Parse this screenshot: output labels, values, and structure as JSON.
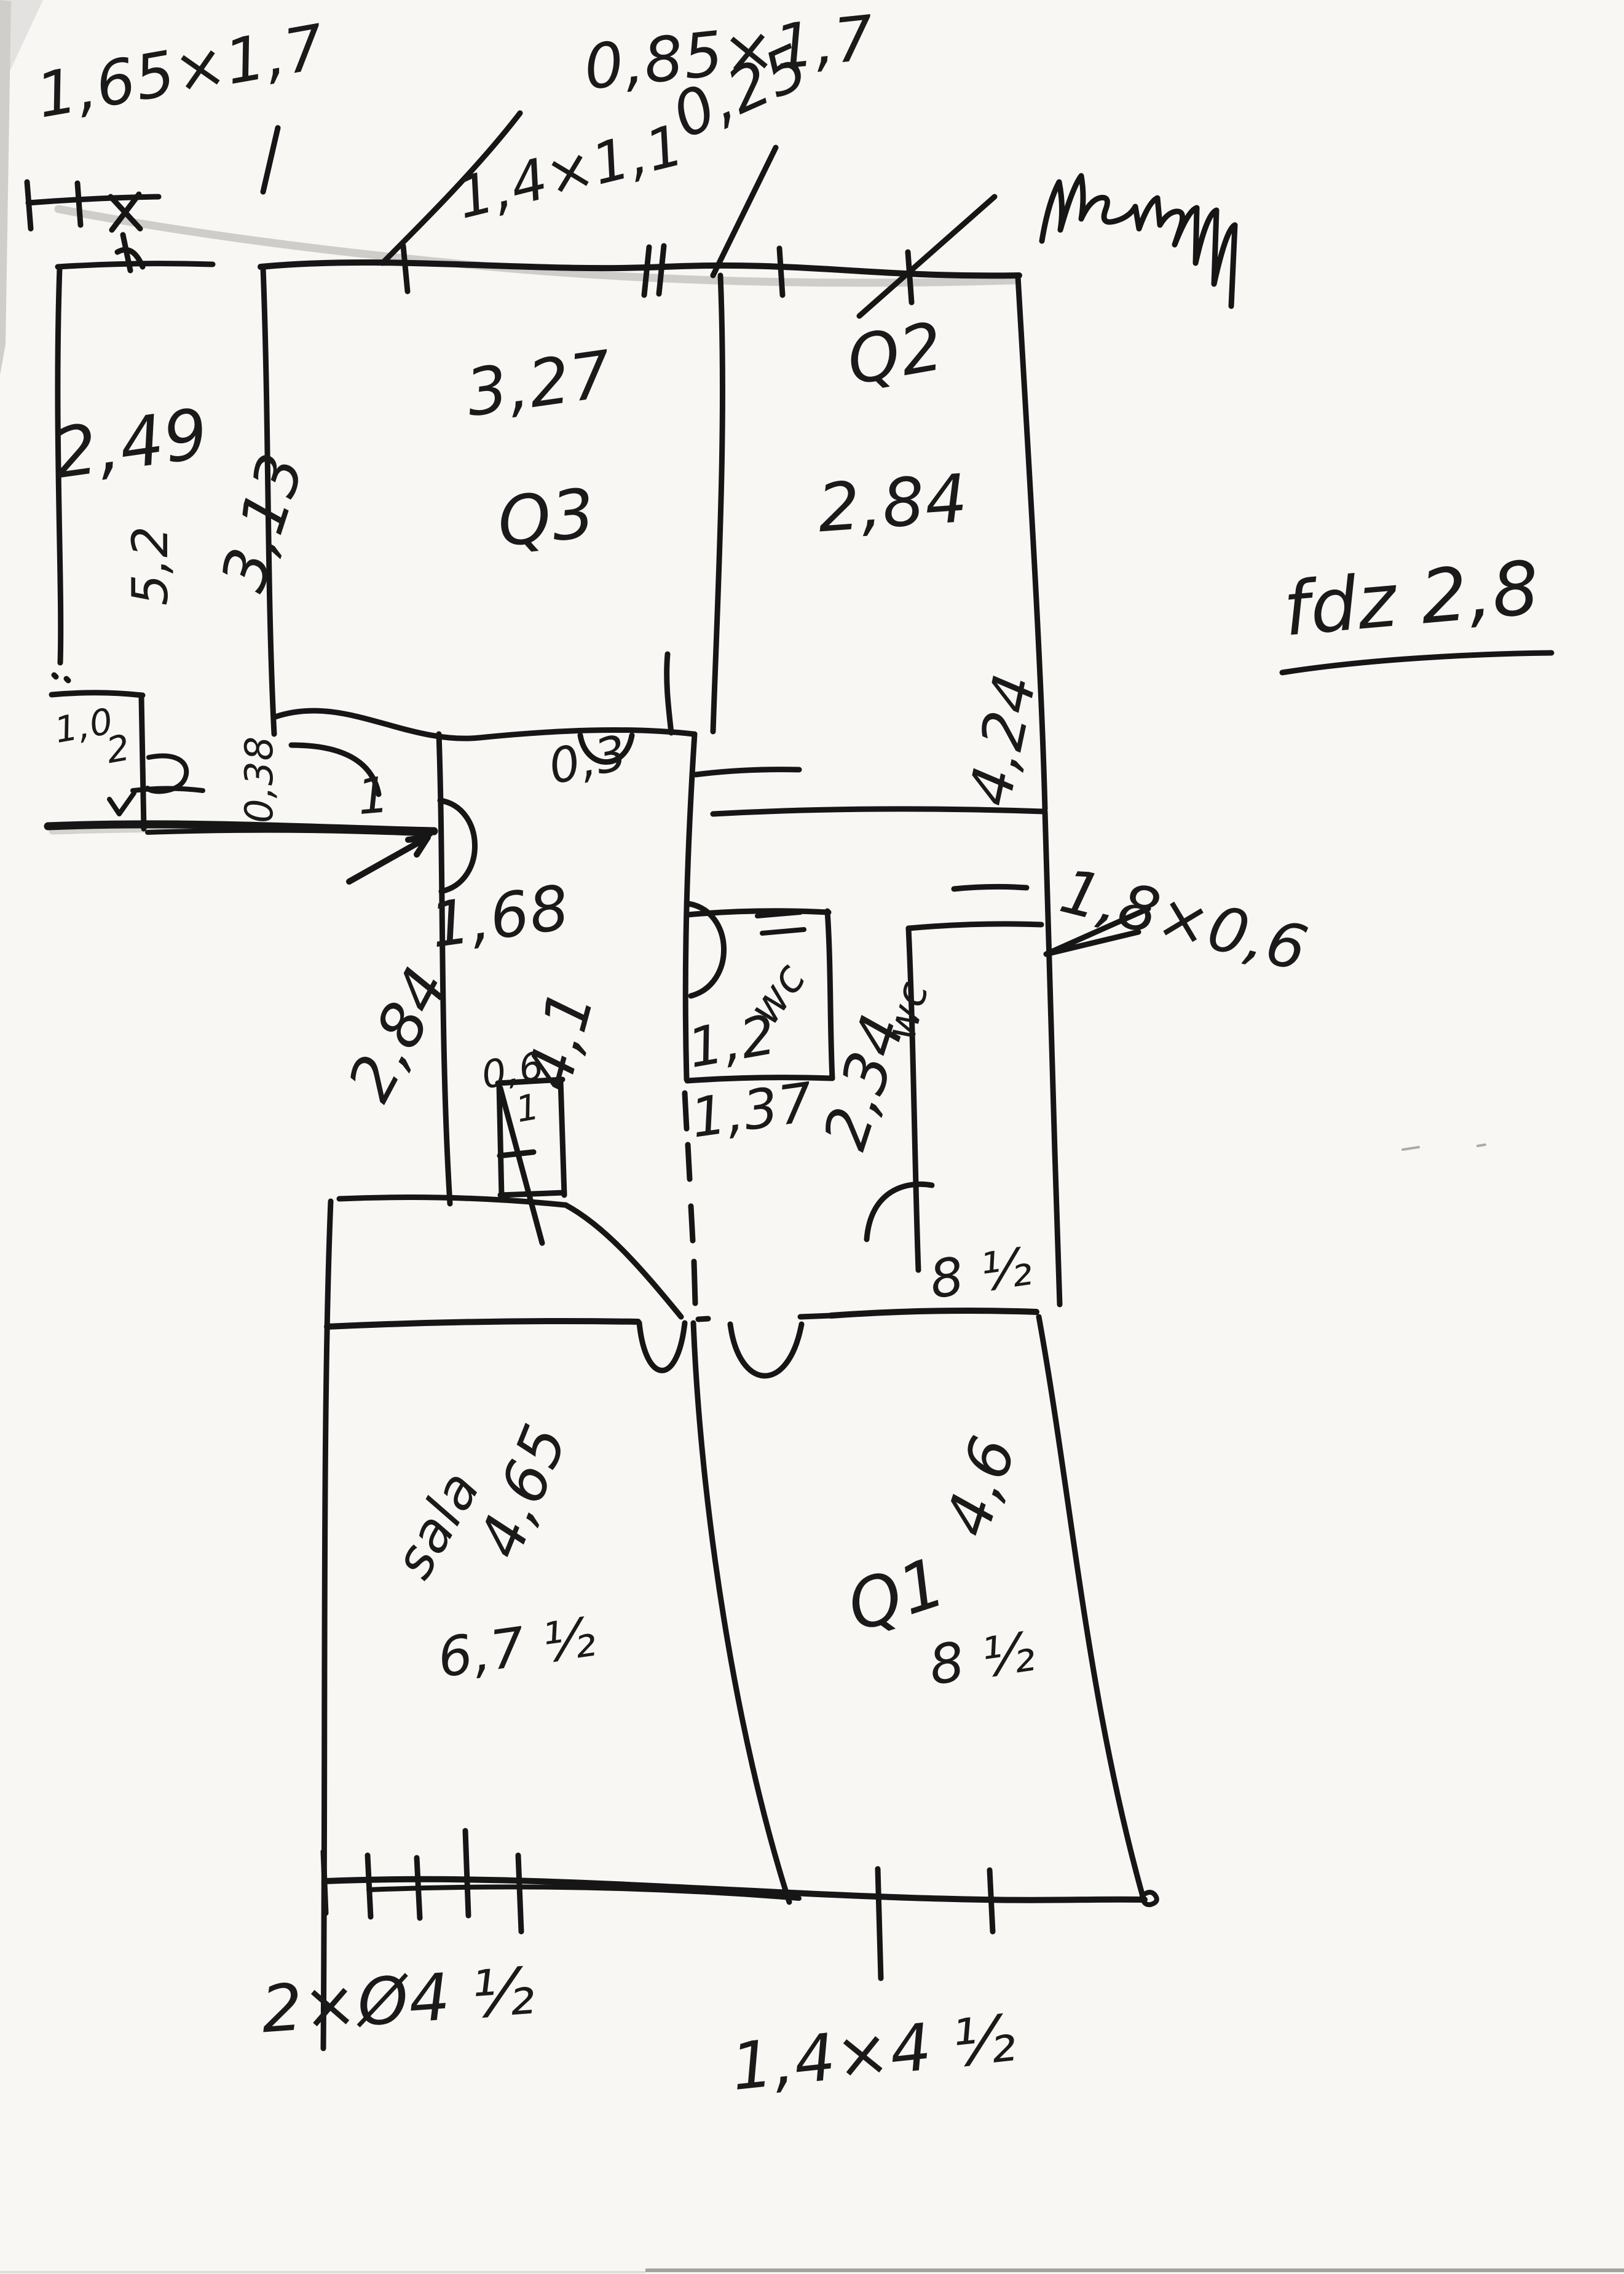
{
  "meta": {
    "kind": "hand-drawn floor plan sketch, black pen on white scanned paper",
    "ink_color": "#161616",
    "paper_color": "#f8f7f4",
    "pencil_color": "#8b8a85"
  },
  "labels": {
    "win_left_outer": "1,65×1,7",
    "win_left_inner": "0,85×1,7",
    "win_top": "1,4×1,1",
    "dim_small_top": "0,25",
    "room1_w": "2,49",
    "room1_h": "5,2",
    "alcove_a": "1,0",
    "alcove_b": "2",
    "q3_name": "Q3",
    "q3_w": "3,27",
    "q3_h": "3,13",
    "q2_name": "Q2",
    "q2_w": "2,84",
    "q2_h": "4,24",
    "note_fdz": "fdz 2,8",
    "niche": "0,3",
    "hall_w": "1,68",
    "hall_len": "4,1",
    "hall_side": "2,84",
    "wall_038": "0,38",
    "entry_1": "1",
    "closet_w": "0,6",
    "closet_1": "1",
    "wc1_name": "wc",
    "wc1_w": "1,2",
    "wc1_d": "1,37",
    "wc2_name": "wc",
    "wc2_h": "2,34",
    "wc2_dim": "1,8×0,6",
    "wc2_b": "8 ½",
    "sala_name": "sala",
    "sala_h": "4,65",
    "sala_b": "6,7 ½",
    "q1_name": "Q1",
    "q1_h": "4,6",
    "q1_b": "8 ½",
    "note_bottom_left": "2×Ø4 ½",
    "note_bottom_right": "1,4×4 ½"
  }
}
